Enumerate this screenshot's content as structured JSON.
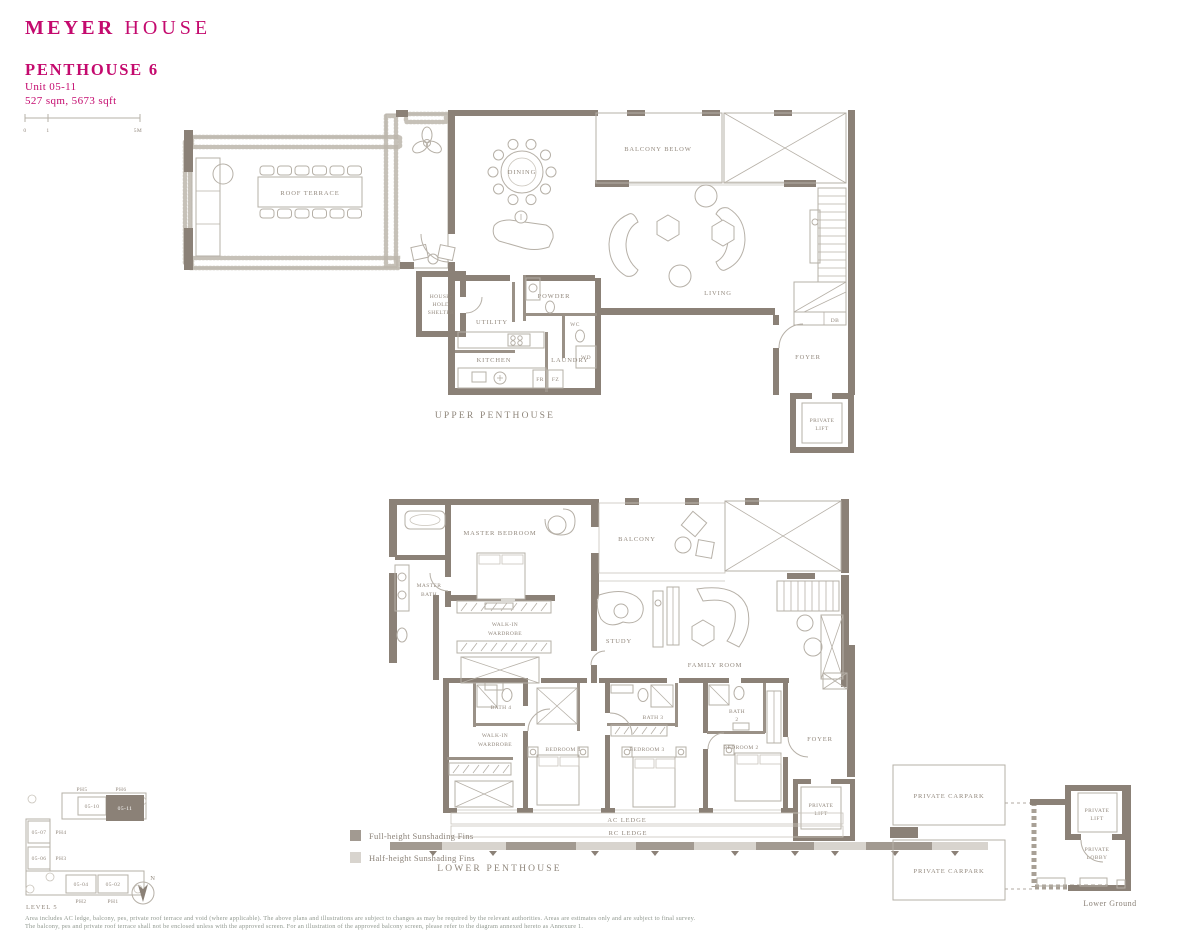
{
  "brand": {
    "bold": "MEYER",
    "light": "HOUSE"
  },
  "header": {
    "title": "PENTHOUSE 6",
    "unit": "Unit 05-11",
    "area": "527 sqm, 5673 sqft"
  },
  "scale": {
    "t0": "0",
    "t1": "1",
    "t2": "5M"
  },
  "upper": {
    "floor_label": "UPPER PENTHOUSE",
    "roof_terrace": "ROOF TERRACE",
    "dining": "DINING",
    "balcony_below": "BALCONY BELOW",
    "living": "LIVING",
    "household": [
      "HOUSE-",
      "HOLD",
      "SHELTER"
    ],
    "utility": "UTILITY",
    "powder": "POWDER",
    "wc": "WC",
    "wd": "WD",
    "kitchen": "KITCHEN",
    "laundry": "LAUNDRY",
    "fr": "FR",
    "fz": "FZ",
    "db": "DB",
    "foyer": "FOYER",
    "lift": [
      "PRIVATE",
      "LIFT"
    ]
  },
  "lower": {
    "floor_label": "LOWER PENTHOUSE",
    "master_bedroom": "MASTER BEDROOM",
    "master_bath": [
      "MASTER",
      "BATH"
    ],
    "walk_in": [
      "WALK-IN",
      "WARDROBE"
    ],
    "study": "STUDY",
    "balcony": "BALCONY",
    "family_room": "FAMILY ROOM",
    "bath4": "BATH 4",
    "bath3": "BATH 3",
    "bath2": [
      "BATH",
      "2"
    ],
    "bedroom4": "BEDROOM 4",
    "bedroom3": "BEDROOM 3",
    "bedroom2": "BEDROOM 2",
    "foyer": "FOYER",
    "lift": [
      "PRIVATE",
      "LIFT"
    ],
    "ac_ledge": "AC LEDGE",
    "rc_ledge": "RC LEDGE"
  },
  "legend": {
    "full": "Full-height Sunshading Fins",
    "half": "Half-height Sunshading Fins"
  },
  "key_plan": {
    "level": "LEVEL 5",
    "north": "N",
    "ph5": "PH5",
    "ph6": "PH6",
    "u10": "05-10",
    "u11": "05-11",
    "ph4": "PH4",
    "u07": "05-07",
    "ph3": "PH3",
    "u06": "05-06",
    "ph2": "PH2",
    "u04": "05-04",
    "ph1": "PH1",
    "u02": "05-02"
  },
  "basement": {
    "carpark": "PRIVATE CARPARK",
    "lift": [
      "PRIVATE",
      "LIFT"
    ],
    "lobby": [
      "PRIVATE",
      "LOBBY"
    ],
    "level": "Lower Ground"
  },
  "notes": [
    "Area includes AC ledge, balcony, pes, private roof terrace and void (where applicable). The above plans and illustrations are subject to changes as may be required by the relevant authorities. Areas are estimates only and are subject to final survey.",
    "The balcony, pes and private roof terrace shall not be enclosed unless with the approved screen. For an illustration of the approved balcony screen, please refer to the diagram annexed hereto as Annexure 1."
  ],
  "colors": {
    "brand": "#c40a6e",
    "wall": "#8b8177",
    "line": "#b6b0a7",
    "label": "#93897e",
    "fin_dark": "#a29a91",
    "fin_light": "#d8d4ce"
  }
}
